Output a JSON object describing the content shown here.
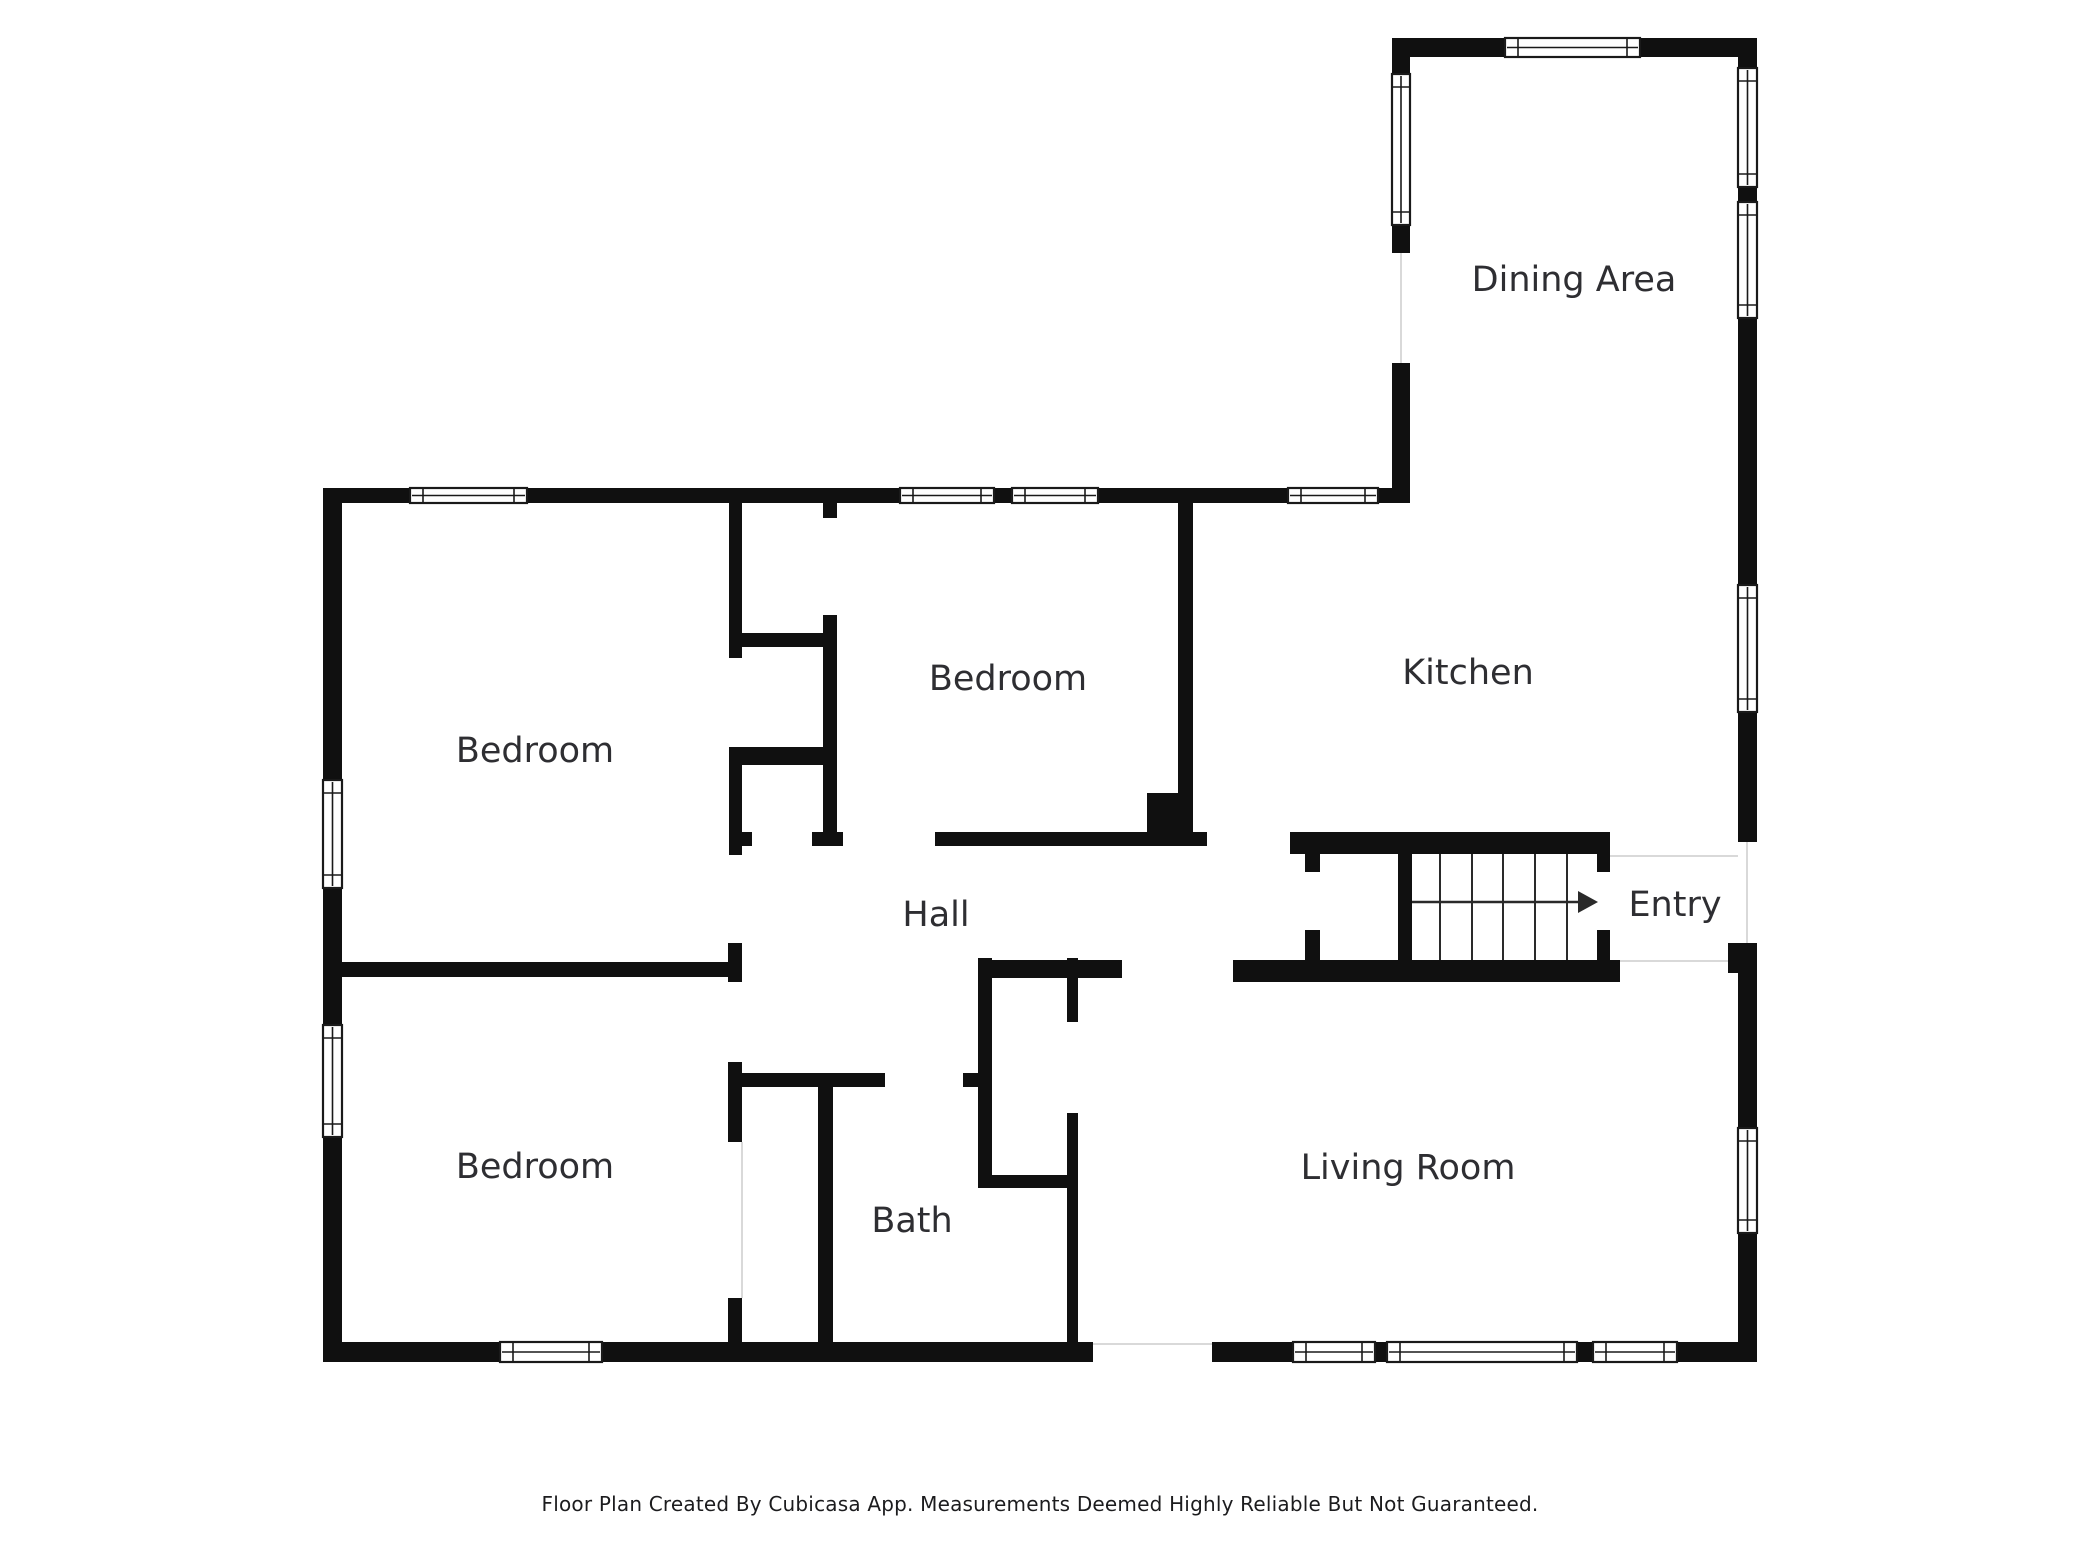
{
  "canvas": {
    "width": 2080,
    "height": 1560
  },
  "colors": {
    "background": "#ffffff",
    "wall": "#101010",
    "label": "#2e2e32",
    "window_fill": "#ffffff",
    "window_stroke": "#1a1a1a",
    "boundary_line": "#d9d9d9",
    "stair_stroke": "#2a2a2a"
  },
  "footer": {
    "disclaimer": "Floor Plan Created By Cubicasa App. Measurements Deemed Highly Reliable But Not Guaranteed."
  },
  "rooms": [
    {
      "id": "dining-area",
      "label": "Dining Area",
      "x": 1574,
      "y": 281
    },
    {
      "id": "kitchen",
      "label": "Kitchen",
      "x": 1468,
      "y": 674
    },
    {
      "id": "bedroom-middle",
      "label": "Bedroom",
      "x": 1008,
      "y": 680
    },
    {
      "id": "bedroom-left-top",
      "label": "Bedroom",
      "x": 535,
      "y": 752
    },
    {
      "id": "bedroom-left-bottom",
      "label": "Bedroom",
      "x": 535,
      "y": 1168
    },
    {
      "id": "hall",
      "label": "Hall",
      "x": 936,
      "y": 916
    },
    {
      "id": "bath",
      "label": "Bath",
      "x": 912,
      "y": 1222
    },
    {
      "id": "living-room",
      "label": "Living Room",
      "x": 1408,
      "y": 1169
    },
    {
      "id": "entry",
      "label": "Entry",
      "x": 1675,
      "y": 906
    }
  ],
  "plan": {
    "walls": [
      [
        323,
        488,
        87,
        15
      ],
      [
        527,
        488,
        373,
        15
      ],
      [
        994,
        488,
        18,
        15
      ],
      [
        1098,
        488,
        190,
        15
      ],
      [
        1378,
        488,
        32,
        15
      ],
      [
        323,
        488,
        19,
        292
      ],
      [
        323,
        888,
        19,
        137
      ],
      [
        323,
        1137,
        19,
        225
      ],
      [
        323,
        1342,
        177,
        20
      ],
      [
        602,
        1342,
        491,
        20
      ],
      [
        1212,
        1342,
        81,
        20
      ],
      [
        1375,
        1342,
        12,
        20
      ],
      [
        1577,
        1342,
        16,
        20
      ],
      [
        1677,
        1342,
        80,
        20
      ],
      [
        1738,
        38,
        19,
        30
      ],
      [
        1738,
        187,
        19,
        15
      ],
      [
        1738,
        318,
        19,
        267
      ],
      [
        1738,
        712,
        19,
        130
      ],
      [
        1738,
        943,
        19,
        185
      ],
      [
        1738,
        1233,
        19,
        129
      ],
      [
        1728,
        943,
        10,
        30
      ],
      [
        1392,
        38,
        113,
        19
      ],
      [
        1640,
        38,
        117,
        19
      ],
      [
        1392,
        38,
        18,
        36
      ],
      [
        1392,
        225,
        18,
        28
      ],
      [
        1392,
        363,
        18,
        140
      ],
      [
        729,
        503,
        13,
        155
      ],
      [
        729,
        747,
        13,
        108
      ],
      [
        823,
        503,
        14,
        15
      ],
      [
        823,
        615,
        14,
        220
      ],
      [
        729,
        633,
        108,
        14
      ],
      [
        729,
        747,
        108,
        18
      ],
      [
        729,
        832,
        23,
        14
      ],
      [
        812,
        832,
        31,
        14
      ],
      [
        935,
        832,
        272,
        14
      ],
      [
        1178,
        503,
        15,
        290
      ],
      [
        342,
        962,
        400,
        15
      ],
      [
        728,
        943,
        14,
        39
      ],
      [
        728,
        1062,
        14,
        80
      ],
      [
        728,
        1298,
        14,
        44
      ],
      [
        742,
        1073,
        143,
        14
      ],
      [
        963,
        1073,
        29,
        14
      ],
      [
        818,
        1087,
        15,
        255
      ],
      [
        978,
        958,
        14,
        230
      ],
      [
        978,
        1175,
        89,
        13
      ],
      [
        1067,
        958,
        11,
        64
      ],
      [
        1067,
        1113,
        11,
        229
      ],
      [
        980,
        960,
        142,
        18
      ],
      [
        1233,
        960,
        387,
        22
      ],
      [
        1290,
        832,
        320,
        22
      ],
      [
        1305,
        854,
        15,
        18
      ],
      [
        1305,
        930,
        15,
        30
      ],
      [
        1398,
        854,
        14,
        106
      ],
      [
        1597,
        854,
        13,
        18
      ],
      [
        1597,
        930,
        13,
        30
      ]
    ],
    "chimney": [
      1147,
      793,
      46,
      47
    ],
    "windows": [
      [
        410,
        488,
        117,
        15
      ],
      [
        900,
        488,
        94,
        15
      ],
      [
        1012,
        488,
        86,
        15
      ],
      [
        1288,
        488,
        90,
        15
      ],
      [
        323,
        780,
        19,
        108
      ],
      [
        323,
        1025,
        19,
        112
      ],
      [
        500,
        1342,
        102,
        20
      ],
      [
        1293,
        1342,
        82,
        20
      ],
      [
        1387,
        1342,
        190,
        20
      ],
      [
        1593,
        1342,
        84,
        20
      ],
      [
        1738,
        68,
        19,
        119
      ],
      [
        1738,
        202,
        19,
        116
      ],
      [
        1738,
        585,
        19,
        127
      ],
      [
        1738,
        1128,
        19,
        105
      ],
      [
        1392,
        74,
        18,
        151
      ],
      [
        1505,
        38,
        135,
        19
      ]
    ],
    "openings": [
      [
        1747,
        842,
        1747,
        943
      ],
      [
        1401,
        253,
        1401,
        363
      ],
      [
        1093,
        1344,
        1212,
        1344
      ],
      [
        742,
        1142,
        742,
        1298
      ],
      [
        1620,
        961,
        1728,
        961
      ],
      [
        1610,
        856,
        1738,
        856
      ]
    ],
    "stairs": {
      "treads_x": [
        1440,
        1472,
        1503,
        1535,
        1567
      ],
      "tread_y1": 854,
      "tread_y2": 960,
      "arrow": {
        "x1": 1412,
        "y1": 902,
        "x2": 1578,
        "y2": 902
      },
      "arrow_head": "1578,891 1598,902 1578,913"
    }
  }
}
